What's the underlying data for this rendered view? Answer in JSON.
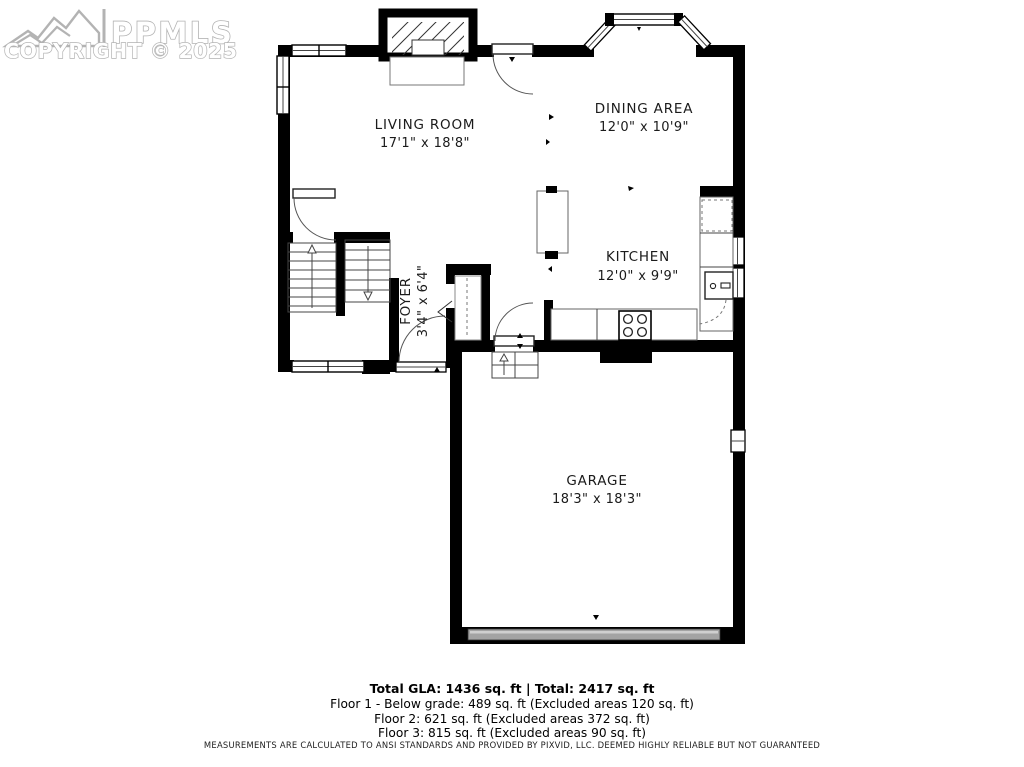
{
  "watermark": {
    "brand": "PPMLS",
    "copyright": "COPYRIGHT © 2025"
  },
  "rooms": {
    "living": {
      "name": "LIVING ROOM",
      "dims": "17'1\" x 18'8\""
    },
    "dining": {
      "name": "DINING AREA",
      "dims": "12'0\" x 10'9\""
    },
    "kitchen": {
      "name": "KITCHEN",
      "dims": "12'0\" x 9'9\""
    },
    "foyer": {
      "name": "FOYER",
      "dims": "3'4\" x 6'4\""
    },
    "garage": {
      "name": "GARAGE",
      "dims": "18'3\" x 18'3\""
    }
  },
  "summary": {
    "total_line": "Total GLA: 1436 sq. ft | Total: 2417 sq. ft",
    "floor_lines": [
      "Floor 1 - Below grade: 489 sq. ft (Excluded areas 120 sq. ft)",
      "Floor 2: 621 sq. ft (Excluded areas 372 sq. ft)",
      "Floor 3: 815 sq. ft (Excluded areas 90 sq. ft)"
    ],
    "disclaimer": "MEASUREMENTS ARE CALCULATED TO ANSI STANDARDS AND PROVIDED BY PIXVID, LLC. DEEMED HIGHLY RELIABLE BUT NOT GUARANTEED"
  },
  "colors": {
    "wall": "#000000",
    "watermark_gray": "#b3b3b3",
    "garage_door_gray": "#a3a3a3",
    "label_text": "#1b1b1b"
  }
}
